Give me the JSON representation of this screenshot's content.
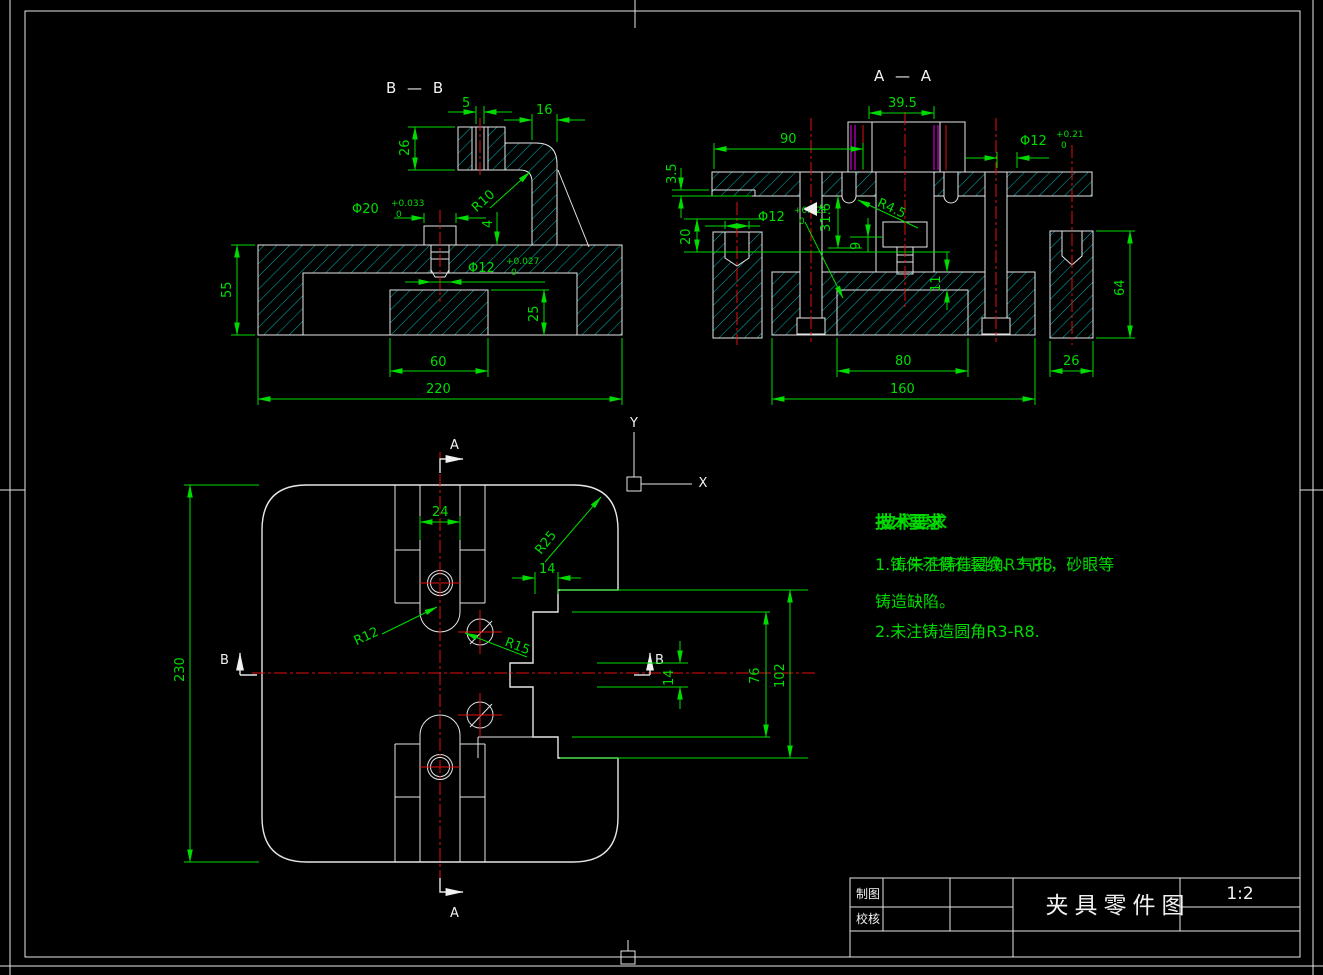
{
  "colors": {
    "background": "#000000",
    "outline": "#e6e6e6",
    "hatch": "#00b4b4",
    "dimension": "#00dc00",
    "centerline": "#e01010",
    "auxiliary": "#ee00ee"
  },
  "views": {
    "bb": {
      "label": "B — B",
      "dims": {
        "hole5": "5",
        "w16": "16",
        "h26": "26",
        "phi20": "Φ20",
        "phi20_up": "+0.033",
        "phi20_dn": "0",
        "r10": "R10",
        "gap4": "4",
        "phi12": "Φ12",
        "phi12_up": "+0.027",
        "phi12_dn": "0",
        "h55": "55",
        "h25": "25",
        "w60": "60",
        "w220": "220"
      }
    },
    "aa": {
      "label": "A — A",
      "dims": {
        "w39_5": "39.5",
        "w90": "90",
        "phi12r": "Φ12",
        "phi12r_up": "+0.21",
        "phi12r_dn": "0",
        "h3_5": "3.5",
        "phi12l": "Φ12",
        "phi12l_up": "+0.021",
        "phi12l_dn": "0",
        "r4_5": "R4.5",
        "h31_6": "31.6",
        "h20": "20",
        "h9": "9",
        "h11": "11",
        "h64": "64",
        "w80": "80",
        "w160": "160",
        "w26": "26"
      }
    },
    "plan": {
      "section_a": "A",
      "section_b": "B",
      "dims": {
        "w24": "24",
        "r25": "R25",
        "w14": "14",
        "r12": "R12",
        "r15": "R15",
        "h230": "230",
        "h14": "14",
        "h76": "76",
        "h102": "102"
      }
    }
  },
  "ucs": {
    "x": "X",
    "y": "Y"
  },
  "tech_requirements": {
    "title": "技术要求",
    "title_ghost": "技术要求",
    "line1": "1.铸件不得有裂纹、气孔，砂眼等",
    "line1_ghost": "1.未注铸造圆角R3-R8",
    "line2": "铸造缺陷。",
    "line3": "2.未注铸造圆角R3-R8."
  },
  "title_block": {
    "drafter_label": "制图",
    "checker_label": "校核",
    "drawing_title": "夹具零件图",
    "scale": "1:2"
  }
}
